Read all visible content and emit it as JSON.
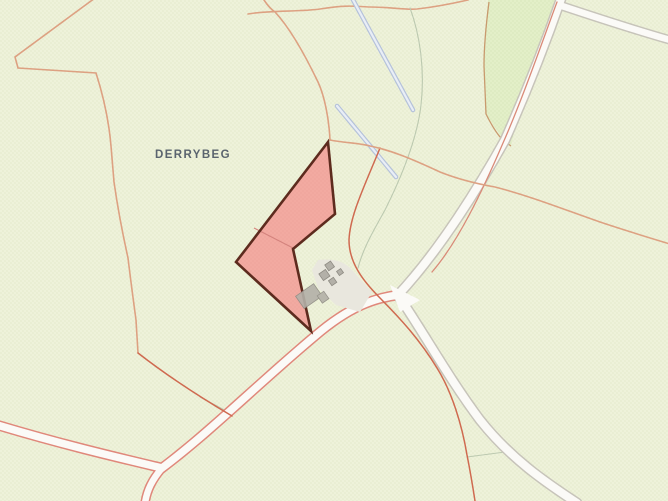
{
  "map": {
    "townland_label": "DERRYBEG",
    "colors": {
      "background": "#eef2da",
      "field_green": "#e3efc8",
      "field_boundary_brown": "#c89a6e",
      "parcel_fill": "#f2a49c",
      "parcel_border": "#5d2b1e",
      "parcel_inner_line": "#d4837d",
      "road_fill": "#fbfaf7",
      "road_casing_gray": "#c7c4ba",
      "road_casing_red": "#e0887b",
      "boundary_tan": "#dda182",
      "line_red": "#cf6a50",
      "line_red_thin": "#d98a78",
      "stream_blue": "#b5c2da",
      "stream_core": "#e9eef6",
      "curve_gray": "#bcc9b0",
      "building_fill": "#b3b0a8",
      "building_stroke": "#8e8b83",
      "yard_fill": "#e9e7de",
      "label_color": "#5a646e",
      "dot_bg": "#bfce98",
      "dot_field": "#b4c98d",
      "dot_parcel": "#dd8f86"
    }
  }
}
